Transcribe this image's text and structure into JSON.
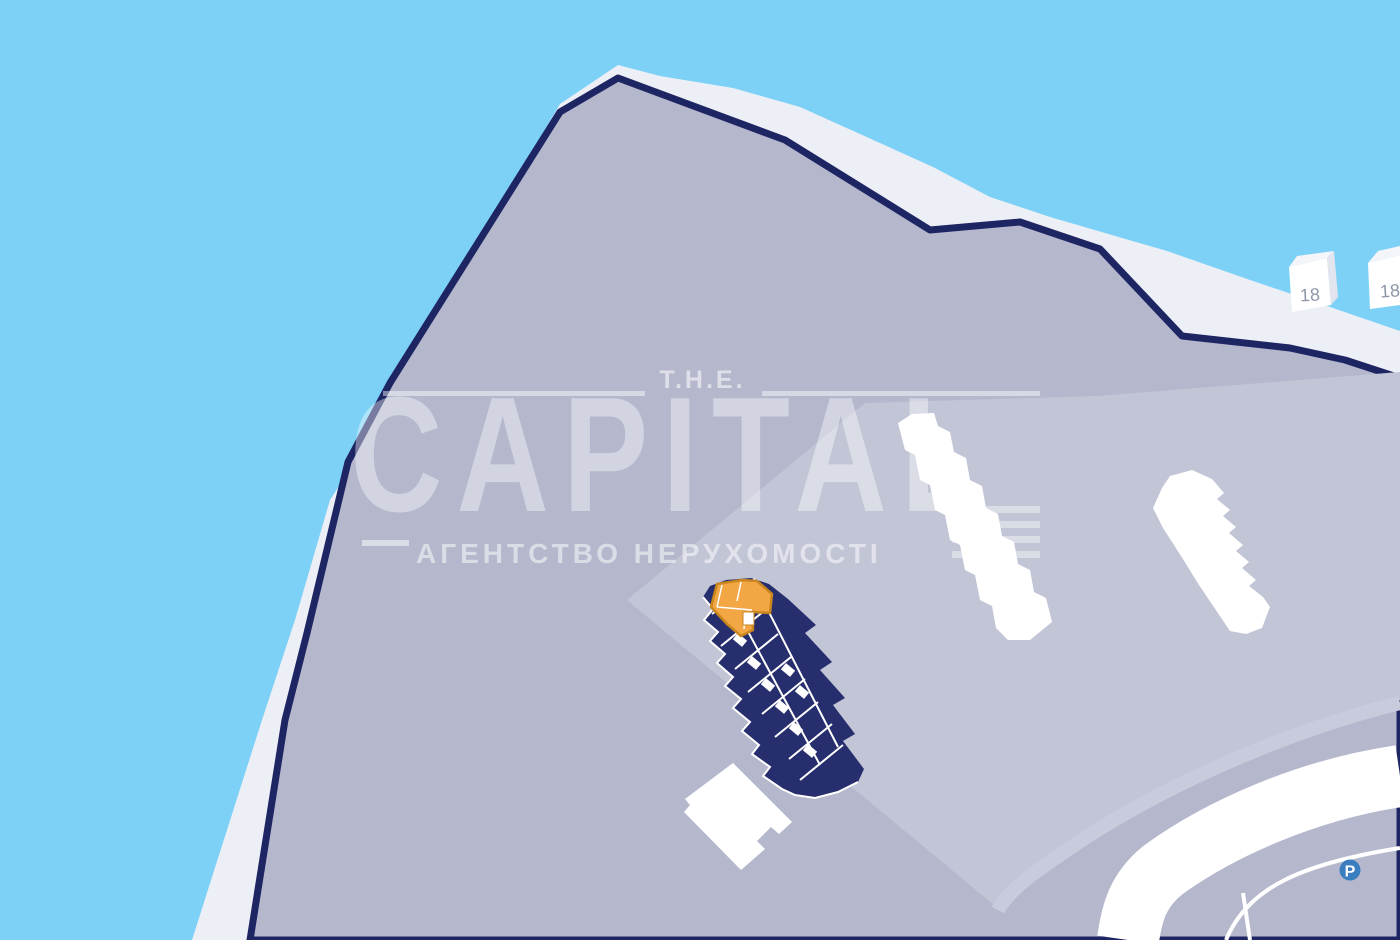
{
  "watermark": {
    "brand_top": "T.H.E.",
    "brand_title": "CAPITAL",
    "brand_subtitle": "АГЕНТСТВО НЕРУХОМОСТІ"
  },
  "map": {
    "neighbor_buildings": [
      {
        "label": "18"
      },
      {
        "label": "18"
      }
    ],
    "parking": {
      "label": "P"
    },
    "colors": {
      "water": "#7ed1f6",
      "shoreline_white": "#edeff7",
      "land": "#b5b8cd",
      "land_light": "#c2c5d6",
      "coast_border_navy": "#1e2563",
      "complex_navy": "#272e6d",
      "selected_unit_orange": "#f2a644",
      "selected_unit_border": "#c9861f",
      "building_white": "#ffffff",
      "road_stripe": "#c8cbdb",
      "parking_blue": "#3b7ec0",
      "building_label_gray": "#8e96a9"
    }
  }
}
